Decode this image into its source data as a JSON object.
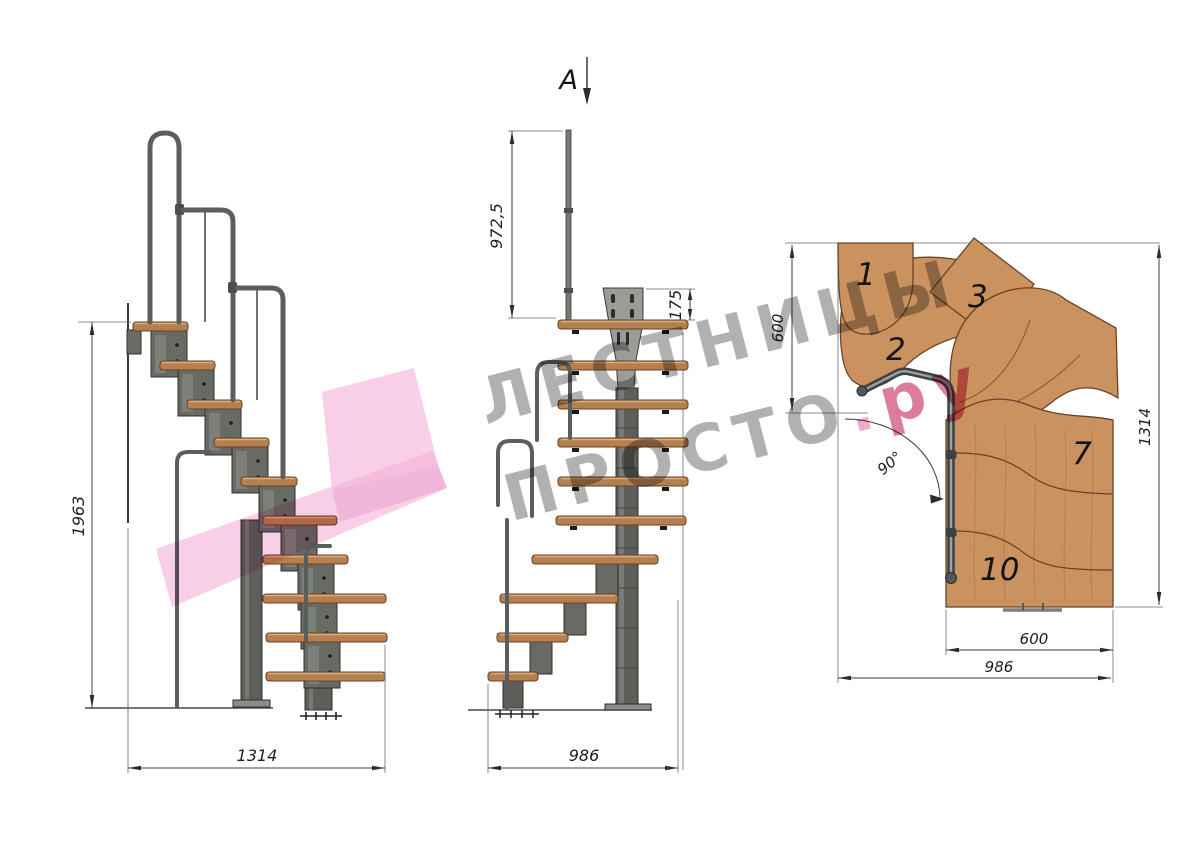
{
  "drawing": {
    "section_marker": "A",
    "watermark": {
      "line1": "ЛЕСТНИЦЫ",
      "line2": "ПРОСТО",
      "dot": ".",
      "suffix": "ру"
    },
    "side_view": {
      "height_mm": "1963",
      "width_mm": "1314"
    },
    "front_view": {
      "rail_height_mm": "972,5",
      "plate_height_mm": "175",
      "width_mm": "986"
    },
    "plan_view": {
      "landing_depth_mm": "600",
      "total_length_mm": "1314",
      "flight_width_mm": "600",
      "total_width_mm": "986",
      "turn_angle": "90°",
      "step_numbers": {
        "s1": "1",
        "s2": "2",
        "s3": "3",
        "s7": "7",
        "s10": "10"
      }
    },
    "colors": {
      "wood": "#c9925f",
      "wood_edge": "#6b4226",
      "metal": "#686b64",
      "logo_pink": "#f3b2d8",
      "watermark_gray": "#6a6a6a",
      "watermark_accent": "#c52d5d"
    }
  }
}
